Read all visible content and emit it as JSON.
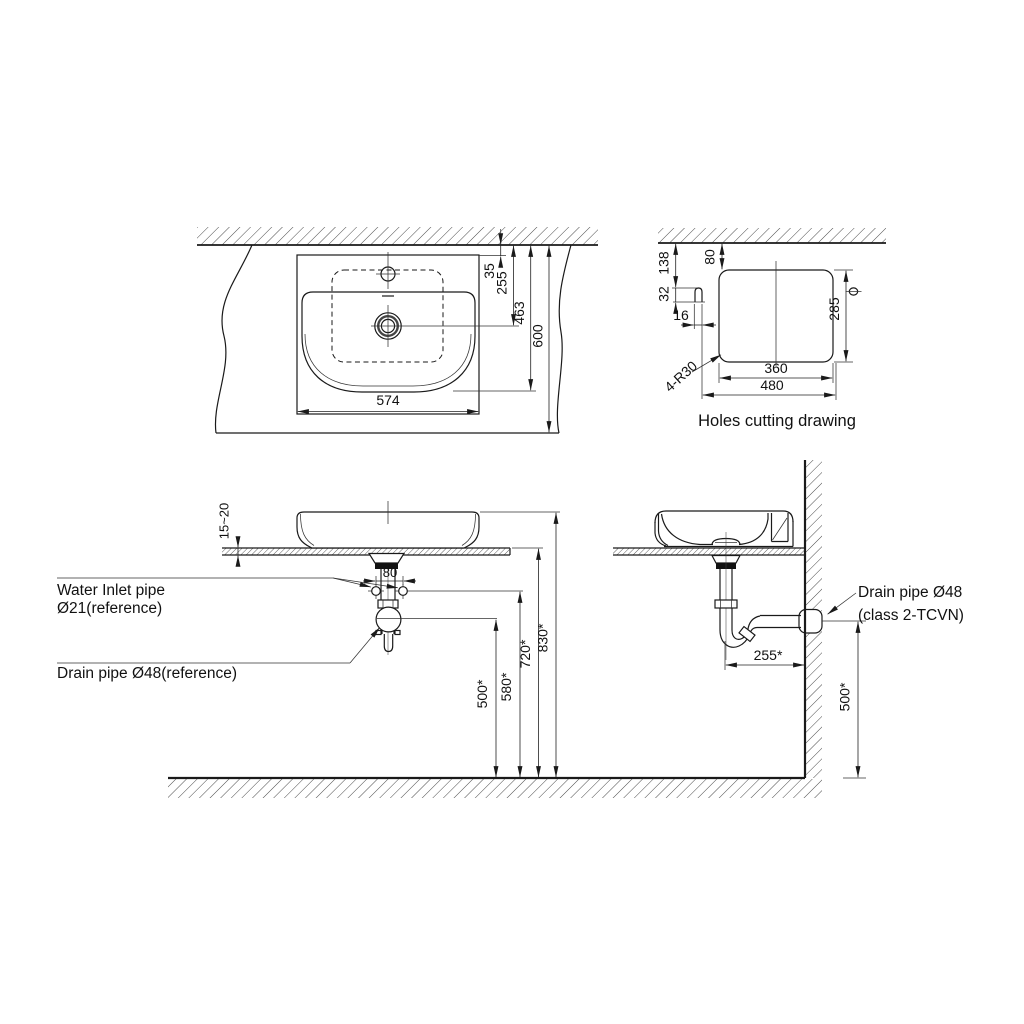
{
  "colors": {
    "line": "#1a1a1a",
    "hatch": "#4a4a4a",
    "background": "#ffffff",
    "seal": "#111111"
  },
  "views": {
    "plan": {
      "dims": {
        "d35": "35",
        "d255": "255",
        "d463": "463",
        "d600": "600",
        "d574": "574"
      }
    },
    "holes": {
      "caption": "Holes cutting drawing",
      "dims": {
        "d138": "138",
        "d80": "80",
        "d32": "32",
        "d16": "16",
        "d285": "285",
        "d360": "360",
        "d480": "480",
        "radius_note": "4-R30"
      }
    },
    "front": {
      "labels": {
        "water_inlet_line1": "Water Inlet pipe",
        "water_inlet_line2": "Ø21(reference)",
        "drain": "Drain pipe Ø48(reference)"
      },
      "dims": {
        "counter_thickness": "15~20",
        "inlet_spacing": "80",
        "d500": "500*",
        "d580": "580*",
        "d720": "720*",
        "d830": "830*"
      }
    },
    "side": {
      "labels": {
        "drain_line1": "Drain pipe Ø48",
        "drain_line2": "(class 2-TCVN)"
      },
      "dims": {
        "d255": "255*",
        "d500": "500*"
      }
    }
  }
}
